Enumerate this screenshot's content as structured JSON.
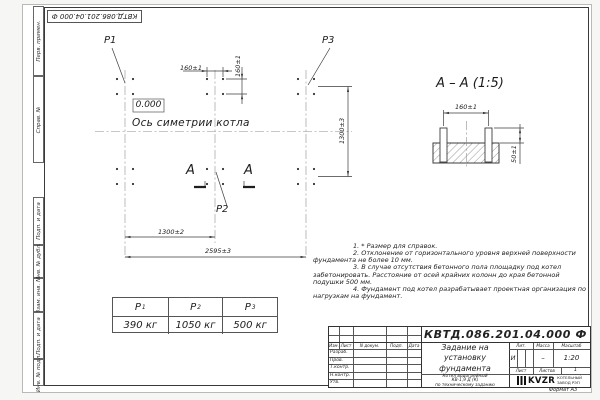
{
  "doc": {
    "number": "КВТД.086.201.04.000  Ф",
    "format_note": "Формат А3"
  },
  "margin_fields": [
    "Перв. примен.",
    "Справ. №",
    "Подп. и дата",
    "Инв. № дубл.",
    "Взам. инв. №",
    "Подп. и дата",
    "Инв. № подл."
  ],
  "plan": {
    "label_p1": "P1",
    "label_p2": "P2",
    "label_p3": "P3",
    "elevation": "0.000",
    "axis_label": "Ось симетрии котла",
    "section_letter": "А",
    "dim_bolt_h": "160±1",
    "dim_bolt_v": "160±1",
    "dim_rows": "1300±3",
    "dim_col": "1300±2",
    "dim_total": "2595±3"
  },
  "section_view": {
    "title": "А  –  А  (1:5)",
    "dim_spacing": "160±1",
    "dim_protrusion": "50±1"
  },
  "notes": [
    "1.  * Размер для справок.",
    "2.  Отклонение от горизонтального уровня верхней поверхности фундамента не более 10 мм.",
    "3.  В случае отсутствия бетонного пола площадку под котел забетонировать. Расстояние от осей крайних колонн до края бетонной подушки 500 мм.",
    "4.  Фундамент под котел разрабатывает проектная организация по нагрузкам на фундамент."
  ],
  "load_table": {
    "cols": [
      {
        "sym": "P",
        "sub": "1",
        "value": "390 кг"
      },
      {
        "sym": "P",
        "sub": "2",
        "value": "1050 кг"
      },
      {
        "sym": "P",
        "sub": "3",
        "value": "500 кг"
      }
    ]
  },
  "title_block": {
    "title_lines": "Задание на\nустановку\nфундамента",
    "subtitle_lines": "Котел водогрейный\nКВ-1,9 Д (К)\nпо техническому заданию",
    "col_izm": "Изм.",
    "col_list": "Лист",
    "col_doc": "N докум.",
    "col_sign": "Подп.",
    "col_date": "Дата",
    "row_razrab": "Разраб.",
    "row_prov": "Пров.",
    "row_tkontr": "Т.контр.",
    "row_nkontr": "Н.контр.",
    "row_utv": "Утв.",
    "lit_label": "Лит.",
    "lit_value": "И",
    "mass_label": "Масса",
    "mass_value": "–",
    "scale_label": "Масштаб",
    "scale_value": "1:20",
    "sheet_label": "Лист",
    "sheets_label": "Листов",
    "sheets_value": "1",
    "company_name": "KVZR",
    "company_desc": "КОТЕЛЬНЫЙ\nЗАВОД РЭП"
  }
}
